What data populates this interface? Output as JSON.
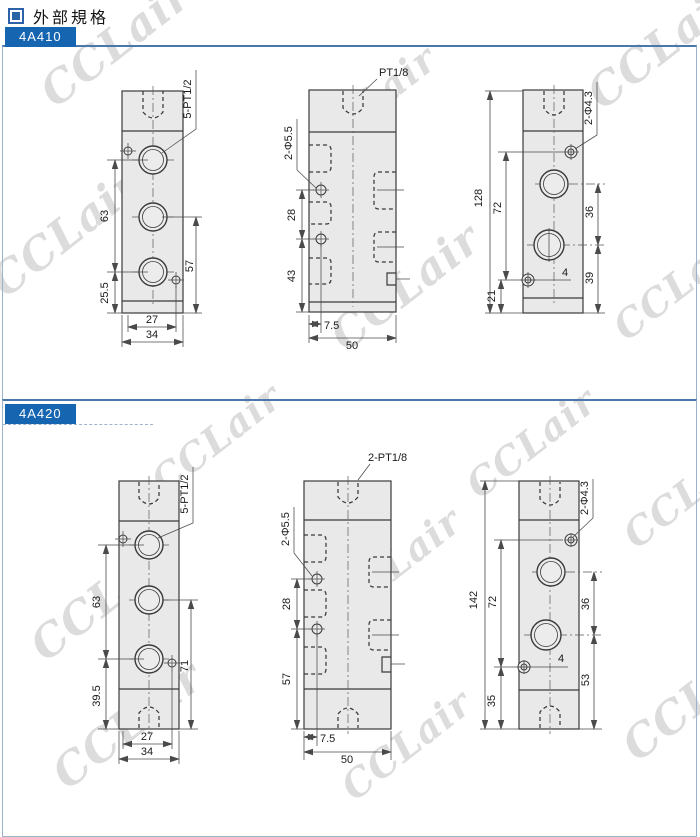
{
  "header": {
    "title": "外部規格"
  },
  "watermark": {
    "text": "CCLair"
  },
  "colors": {
    "accent_blue": "#1565b0",
    "section_border": "#9db2cd",
    "drawing_fill": "#e9e9e9"
  },
  "sections": {
    "a410": {
      "label": "4A410",
      "front": {
        "thread": "5-PT1/2",
        "upper": "63",
        "lower": "25.5",
        "right": "57",
        "inner_width": "27",
        "outer_width": "34"
      },
      "side": {
        "thread": "PT1/8",
        "holes": "2-Φ5.5",
        "pitch": "28",
        "lower": "43",
        "edge": "7.5",
        "width": "50"
      },
      "end": {
        "holes": "2-Φ4.3",
        "total": "128",
        "screw_pitch": "72",
        "port_pitch": "36",
        "lower": "39",
        "bottom": "21",
        "offset": "4"
      }
    },
    "a420": {
      "label": "4A420",
      "front": {
        "thread": "5-PT1/2",
        "upper": "63",
        "lower": "39.5",
        "right": "71",
        "inner_width": "27",
        "outer_width": "34"
      },
      "side": {
        "thread": "2-PT1/8",
        "holes": "2-Φ5.5",
        "pitch": "28",
        "lower": "57",
        "edge": "7.5",
        "width": "50"
      },
      "end": {
        "holes": "2-Φ4.3",
        "total": "142",
        "screw_pitch": "72",
        "port_pitch": "36",
        "lower": "53",
        "bottom": "35",
        "offset": "4"
      }
    }
  }
}
